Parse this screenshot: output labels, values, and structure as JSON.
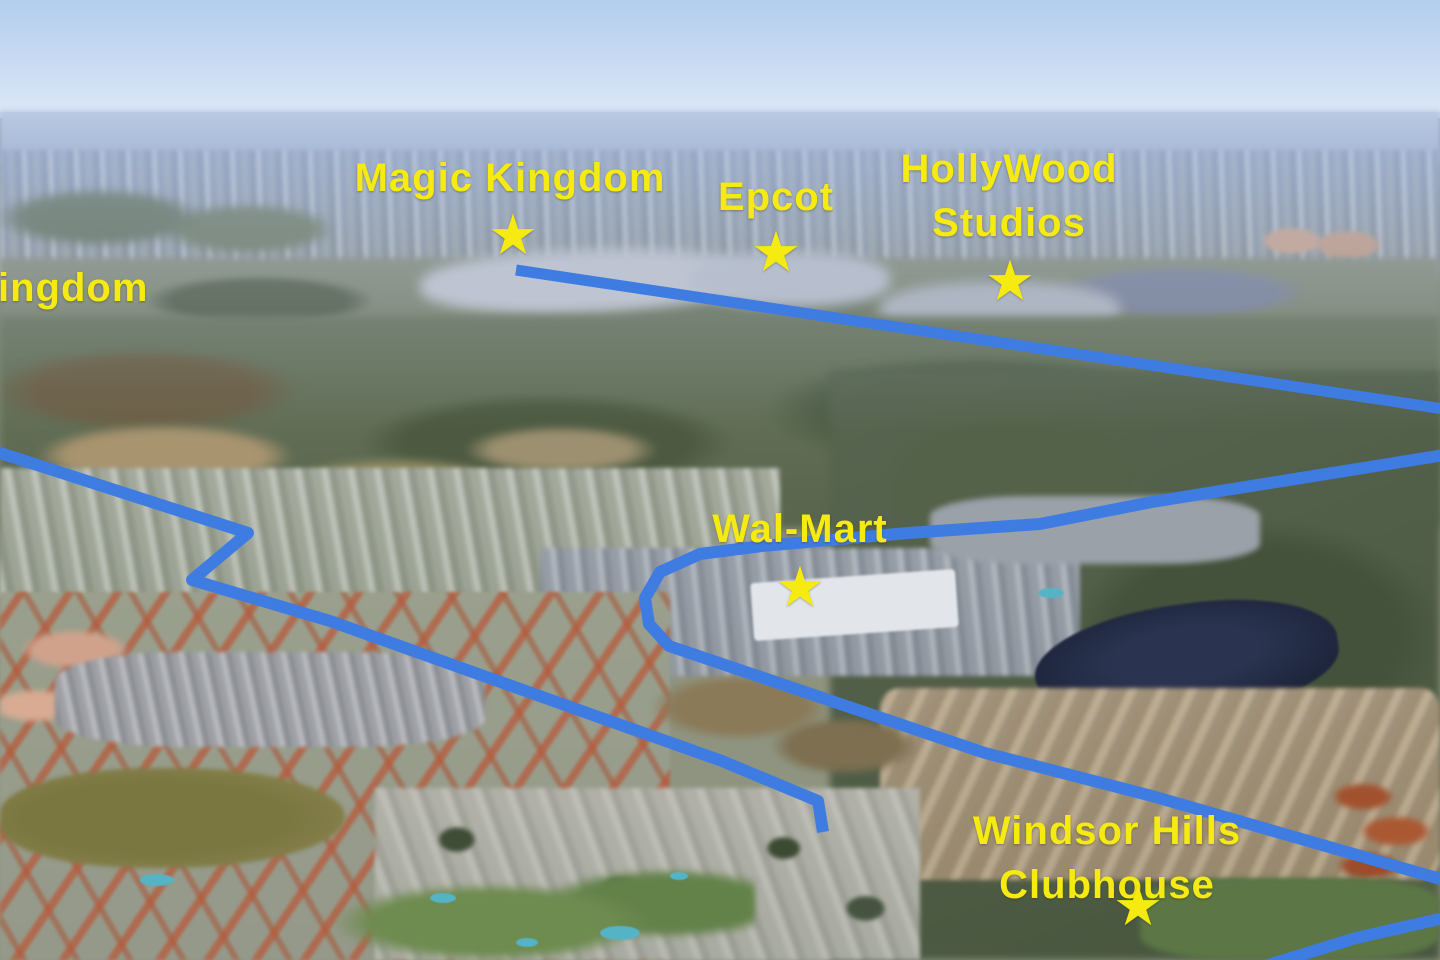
{
  "map": {
    "colors": {
      "label_yellow": "#F5EB10",
      "route_blue": "#3F7CE2"
    },
    "star_glyph": "★",
    "labels": [
      {
        "name": "animal-kingdom-partial",
        "text": "ingdom",
        "x": -2,
        "y": 288,
        "align": "left",
        "star": null
      },
      {
        "name": "magic-kingdom",
        "text": "Magic Kingdom",
        "x": 510,
        "y": 178,
        "star": {
          "x": 513,
          "y": 237
        }
      },
      {
        "name": "epcot",
        "text": "Epcot",
        "x": 776,
        "y": 197,
        "star": {
          "x": 776,
          "y": 254
        }
      },
      {
        "name": "hollywood-studios",
        "text": "HollyWood\nStudios",
        "x": 1009,
        "y": 196,
        "star": {
          "x": 1010,
          "y": 283
        }
      },
      {
        "name": "wal-mart",
        "text": "Wal-Mart",
        "x": 800,
        "y": 529,
        "star": {
          "x": 800,
          "y": 589
        }
      },
      {
        "name": "windsor-hills-clubhouse",
        "text": "Windsor Hills Clubhouse",
        "x": 1107,
        "y": 858,
        "star": {
          "x": 1138,
          "y": 908
        }
      }
    ],
    "routes": [
      {
        "name": "parks-highway",
        "width": 11,
        "points": [
          [
            516,
            270
          ],
          [
            1444,
            409
          ]
        ]
      },
      {
        "name": "west-route",
        "width": 12,
        "points": [
          [
            -6,
            451
          ],
          [
            248,
            533
          ],
          [
            192,
            580
          ],
          [
            330,
            621
          ],
          [
            562,
            704
          ],
          [
            722,
            761
          ],
          [
            818,
            801
          ],
          [
            823,
            832
          ]
        ]
      },
      {
        "name": "east-loop-route",
        "width": 12,
        "points": [
          [
            1444,
            455
          ],
          [
            1152,
            502
          ],
          [
            1040,
            524
          ],
          [
            908,
            533
          ],
          [
            762,
            546
          ],
          [
            700,
            554
          ],
          [
            660,
            572
          ],
          [
            645,
            598
          ],
          [
            649,
            624
          ],
          [
            669,
            646
          ],
          [
            985,
            753
          ],
          [
            1152,
            796
          ],
          [
            1444,
            880
          ]
        ]
      },
      {
        "name": "bottom-right-route",
        "width": 12,
        "points": [
          [
            1268,
            965
          ],
          [
            1356,
            938
          ],
          [
            1444,
            918
          ]
        ]
      }
    ]
  }
}
